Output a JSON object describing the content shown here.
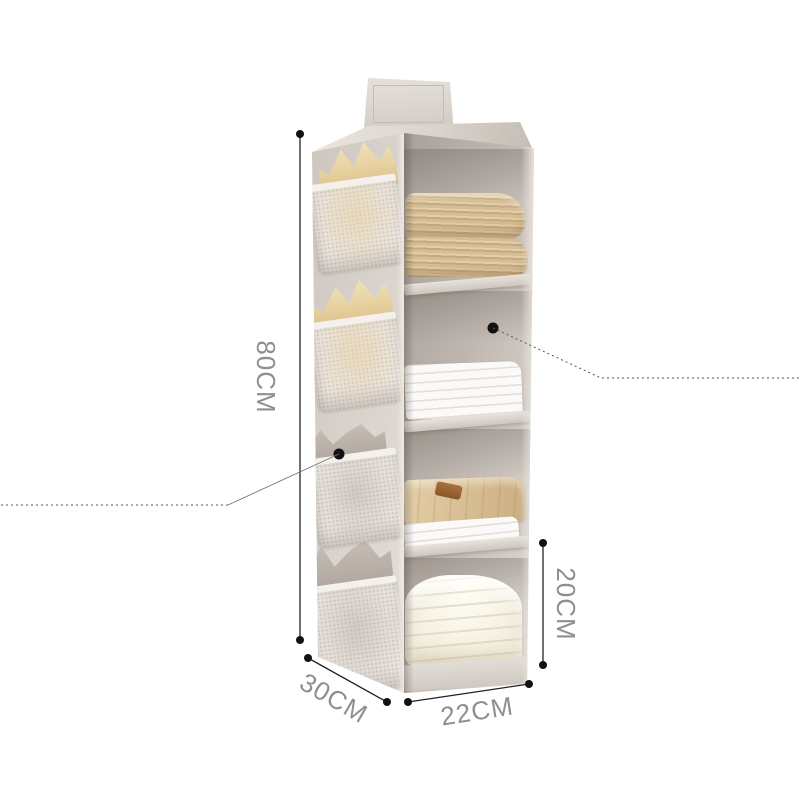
{
  "scene": {
    "description": "White-background photo of a beige hanging fabric closet organizer with four open shelves, side mesh pockets holding bras and folded linens, annotated with measurement lines",
    "background": "#ffffff"
  },
  "dimensions": {
    "height_label": "80CM",
    "depth_label": "30CM",
    "width_label": "22CM",
    "shelf_height_label": "20CM"
  },
  "style": {
    "dimension_line_color": "#222222",
    "dimension_dot_color": "#111111",
    "dimension_text_color": "#8f8f8f",
    "callout_line_color": "#555555",
    "fabric_color": "#d6d0c9",
    "interior_color": "#aaa19b",
    "mesh_color": "#eae5df",
    "pocket_trim_color": "#f4f1ec",
    "knit_sweater_color": "#d7bd93",
    "bra_color": "#eedcb0",
    "linen_color": "#f7f5f2",
    "shirt_color": "#dcc49e",
    "leather_strap_color": "#9c6434",
    "blanket_color": "#f7f3e9"
  }
}
